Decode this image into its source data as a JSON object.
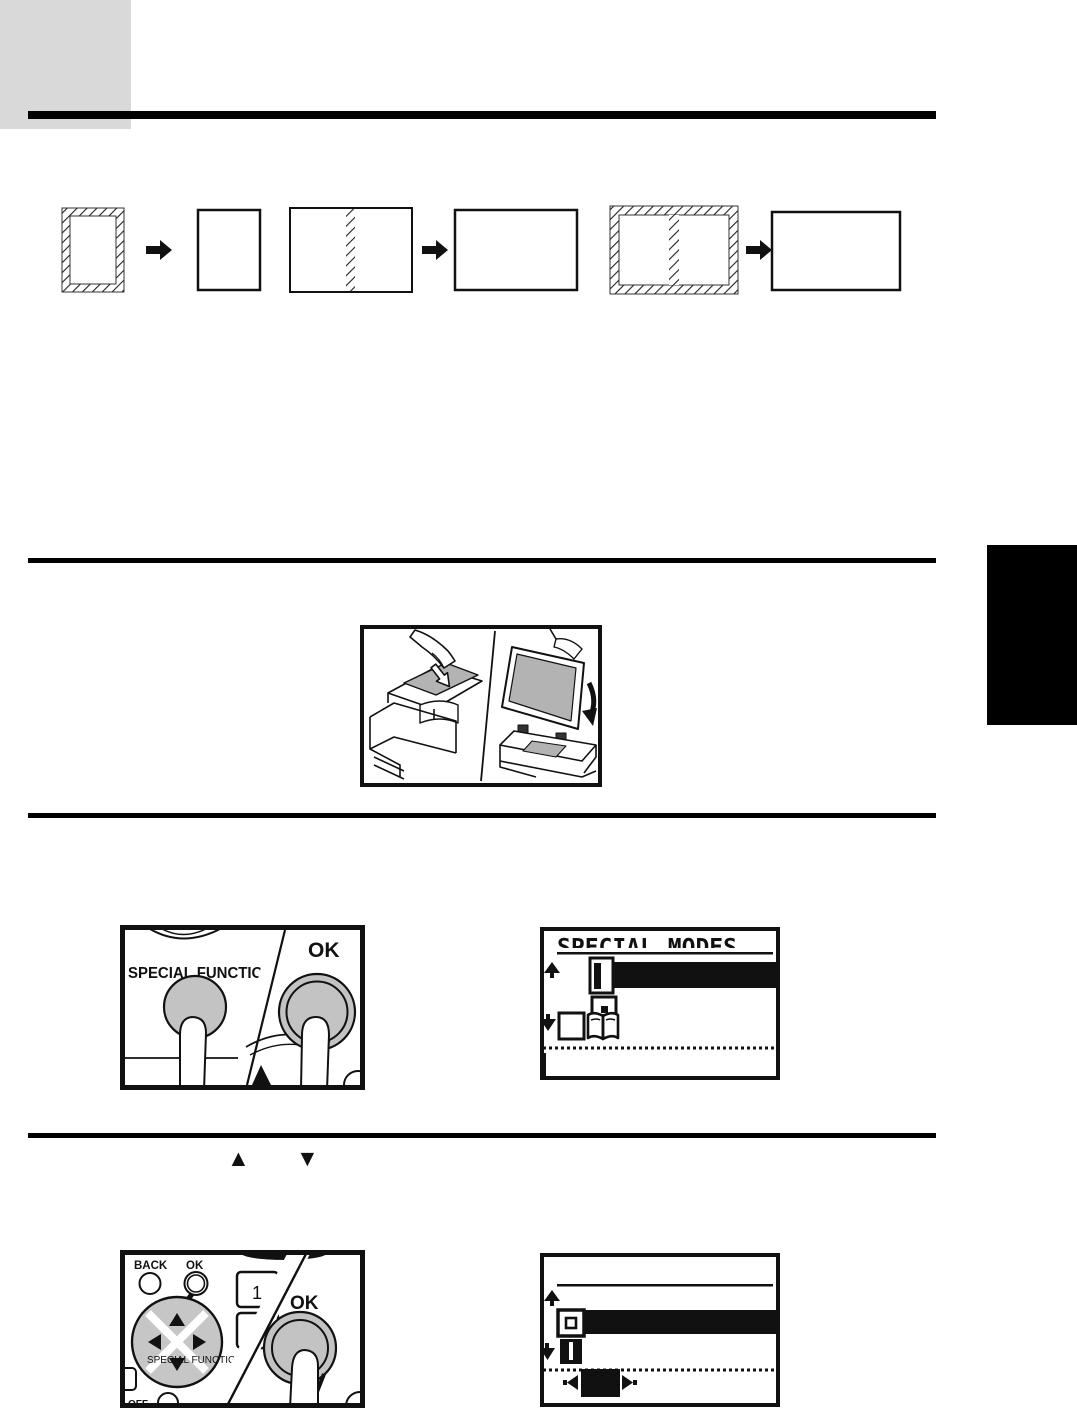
{
  "page": {
    "header_block_color": "#d9d9d9",
    "ink": "#111111",
    "button_gray": "#c3c3c3",
    "pad_gray": "#c6c6c6",
    "document_gray": "#b3b3b3"
  },
  "copy_modes_diagram": {
    "icons": [
      "original-portrait-hatched",
      "arrow-right",
      "copy-portrait",
      "original-landscape-center-split",
      "arrow-right",
      "copy-landscape",
      "original-landscape-hatched-split",
      "arrow-right",
      "copy-landscape"
    ]
  },
  "copier_figure": {
    "icons": [
      "document-feeder-hand-icon",
      "open-cover-hand-icon",
      "down-arrow-icon",
      "rotate-arrow-icon"
    ]
  },
  "step2_keys": {
    "special_function": "SPECIAL FUNCTION",
    "ok": "OK"
  },
  "lcd1": {
    "title": "SPECIAL MODES",
    "icons": [
      "scroll-up-icon",
      "margin-shift-icon",
      "erase-icon",
      "scroll-down-icon",
      "blank-checkbox-icon",
      "dual-page-copy-icon",
      "selected-row-highlight",
      "cursor-line"
    ]
  },
  "step3_keys": {
    "up": "▲",
    "down": "▼"
  },
  "nav_keys": {
    "back": "BACK",
    "ok": "OK",
    "ok_pressed": "OK",
    "key_1": "1",
    "key_4": "4",
    "special_function": "SPECIAL FUNCTION",
    "tab_fragment": "T",
    "off_fragment": "OFF"
  },
  "lcd2": {
    "icons": [
      "scroll-up-icon",
      "erase-icon-outline",
      "scroll-down-icon",
      "book-spine-icon",
      "left-arrow-icon",
      "right-arrow-icon",
      "selected-option-box",
      "selected-row-highlight"
    ]
  }
}
